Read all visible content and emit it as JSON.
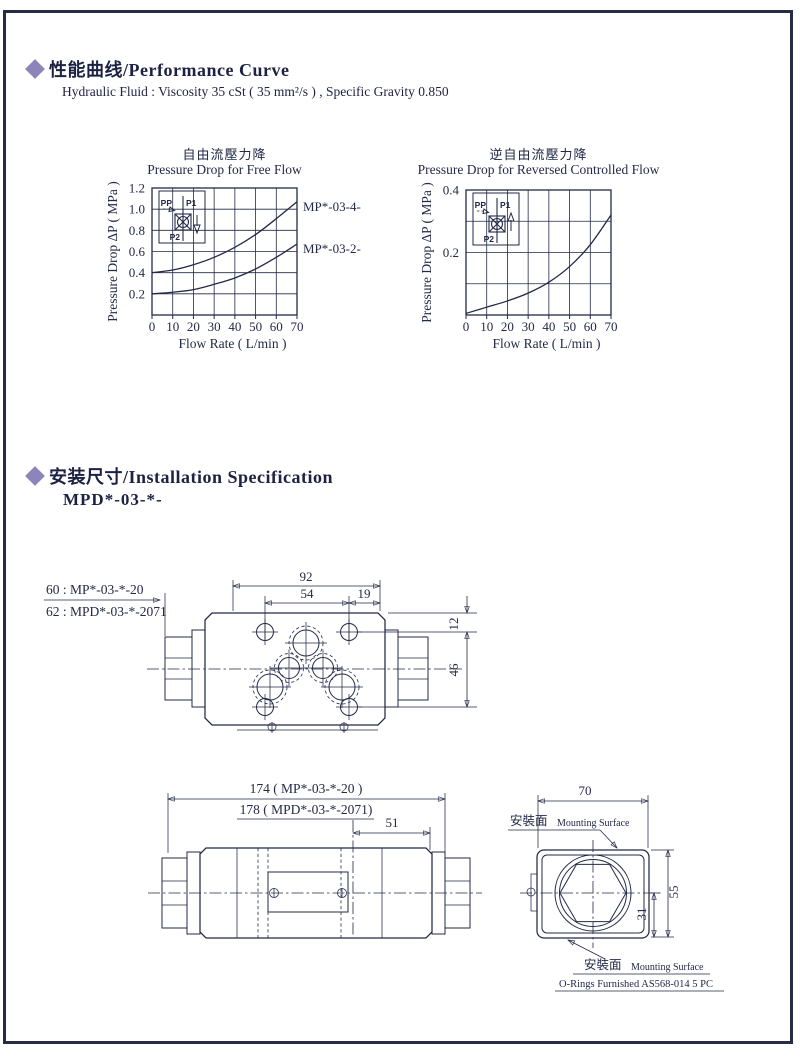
{
  "colors": {
    "ink": "#232947",
    "accent_diamond": "#8c85ba",
    "background": "#ffffff"
  },
  "sections": {
    "performance": {
      "title": "性能曲线/Performance Curve",
      "subtitle": "Hydraulic Fluid : Viscosity 35 cSt ( 35 mm²/s ) , Specific Gravity 0.850"
    },
    "installation": {
      "title": "安装尺寸/Installation Specification",
      "model": "MPD*-03-*-"
    }
  },
  "chart_data": [
    {
      "type": "line",
      "title_zh": "自由流壓力降",
      "title_en": "Pressure Drop for Free Flow",
      "xlabel": "Flow Rate ( L/min )",
      "ylabel": "Pressure Drop ΔP ( MPa )",
      "xlim": [
        0,
        70
      ],
      "ylim": [
        0,
        1.2
      ],
      "xticks": [
        0,
        10,
        20,
        30,
        40,
        50,
        60,
        70
      ],
      "yticks": [
        0.2,
        0.4,
        0.6,
        0.8,
        1.0,
        1.2
      ],
      "ytick_labels": [
        "0.2",
        "0.4",
        "0.6",
        "0.8",
        "1.0",
        "1.2"
      ],
      "grid": true,
      "legend_position": "right-outside",
      "x": [
        0,
        10,
        20,
        30,
        40,
        50,
        60,
        70
      ],
      "series": [
        {
          "name": "MP*-03-4-",
          "values": [
            0.4,
            0.425,
            0.475,
            0.545,
            0.64,
            0.76,
            0.91,
            1.07
          ]
        },
        {
          "name": "MP*-03-2-",
          "values": [
            0.2,
            0.215,
            0.24,
            0.29,
            0.35,
            0.435,
            0.545,
            0.67
          ]
        }
      ],
      "inset": {
        "ports": [
          "PP",
          "P1",
          "P2"
        ],
        "flow_direction": "down"
      }
    },
    {
      "type": "line",
      "title_zh": "逆自由流壓力降",
      "title_en": "Pressure Drop for Reversed Controlled Flow",
      "xlabel": "Flow Rate ( L/min )",
      "ylabel": "Pressure Drop ΔP ( MPa )",
      "xlim": [
        0,
        70
      ],
      "ylim": [
        0,
        0.4
      ],
      "xticks": [
        0,
        10,
        20,
        30,
        40,
        50,
        60,
        70
      ],
      "yticks": [
        0.1,
        0.2,
        0.3,
        0.4
      ],
      "ytick_labels": [
        "",
        "0.2",
        "",
        "0.4"
      ],
      "grid": true,
      "legend_position": "none",
      "x": [
        0,
        10,
        20,
        30,
        40,
        50,
        60,
        70
      ],
      "series": [
        {
          "name": "",
          "values": [
            0.005,
            0.025,
            0.045,
            0.07,
            0.105,
            0.155,
            0.225,
            0.32
          ]
        }
      ],
      "inset": {
        "ports": [
          "PP",
          "P1",
          "P2"
        ],
        "flow_direction": "up"
      }
    }
  ],
  "installation": {
    "leaders": [
      "60 : MP*-03-*-20",
      "62 : MPD*-03-*-2071"
    ],
    "top_view_dims": {
      "width_total": "92",
      "bolt_span": "54",
      "offset": "19",
      "top_offset": "12",
      "height_span": "46"
    },
    "side_view_dims": {
      "length_mp": "174 ( MP*-03-*-20 )",
      "length_mpd": "178 ( MPD*-03-*-2071)",
      "end_len": "51"
    },
    "end_view_dims": {
      "width": "70",
      "height": "55",
      "center_to_bottom": "31"
    },
    "mounting_surface_zh": "安裝面",
    "mounting_surface_en": "Mounting Surface",
    "orings_note": "O-Rings  Furnished  AS568-014  5 PC"
  }
}
